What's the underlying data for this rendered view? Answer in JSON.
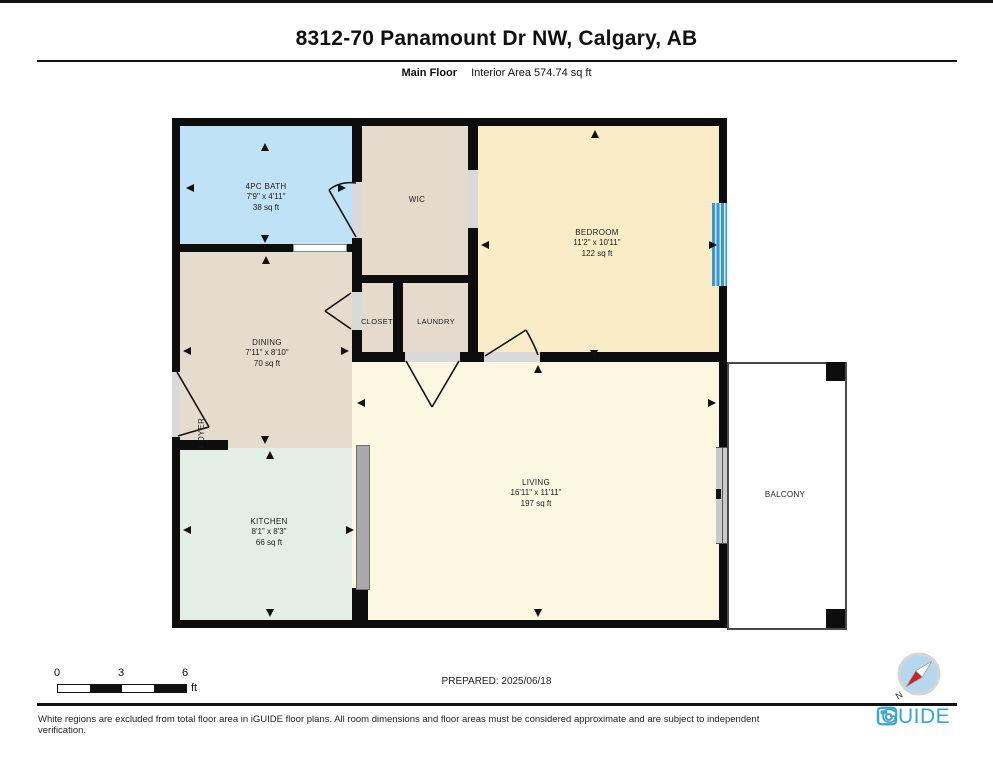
{
  "header": {
    "title": "8312-70 Panamount Dr NW, Calgary, AB",
    "floor_label": "Main Floor",
    "interior_area": "Interior Area 574.74 sq ft"
  },
  "rooms": {
    "bath": {
      "name": "4PC BATH",
      "dims": "7'9\" x 4'11\"",
      "area": "38 sq ft"
    },
    "wic": {
      "name": "WIC"
    },
    "bedroom": {
      "name": "BEDROOM",
      "dims": "11'2\" x 10'11\"",
      "area": "122 sq ft"
    },
    "dining": {
      "name": "DINING",
      "dims": "7'11\" x 8'10\"",
      "area": "70 sq ft"
    },
    "closet": {
      "name": "CLOSET"
    },
    "laundry": {
      "name": "LAUNDRY"
    },
    "foyer": {
      "name": "FOYER"
    },
    "kitchen": {
      "name": "KITCHEN",
      "dims": "8'1\" x 8'3\"",
      "area": "66 sq ft"
    },
    "living": {
      "name": "LIVING",
      "dims": "16'11\" x 11'11\"",
      "area": "197 sq ft"
    },
    "balcony": {
      "name": "BALCONY"
    }
  },
  "scale_bar": {
    "label_0": "0",
    "label_3": "3",
    "label_6": "6",
    "unit": "ft"
  },
  "prepared": "PREPARED: 2025/06/18",
  "compass": {
    "label": "N"
  },
  "footer": {
    "disclaimer": "White regions are excluded from total floor area in iGUIDE floor plans. All room dimensions and floor areas must be considered approximate and are subject to independent verification.",
    "brand": "iGUIDE"
  },
  "colors": {
    "wall": "#0d0d0d",
    "bath_fill": "#bfe2f6",
    "closet_fill": "#e4dbcd",
    "dining_fill": "#e6dccd",
    "bedroom_fill": "#f9ecc6",
    "living_fill": "#fcf7e1",
    "kitchen_fill": "#e3eee7",
    "window_blue": "#3b97d0",
    "brand_blue": "#3aa6cc"
  }
}
